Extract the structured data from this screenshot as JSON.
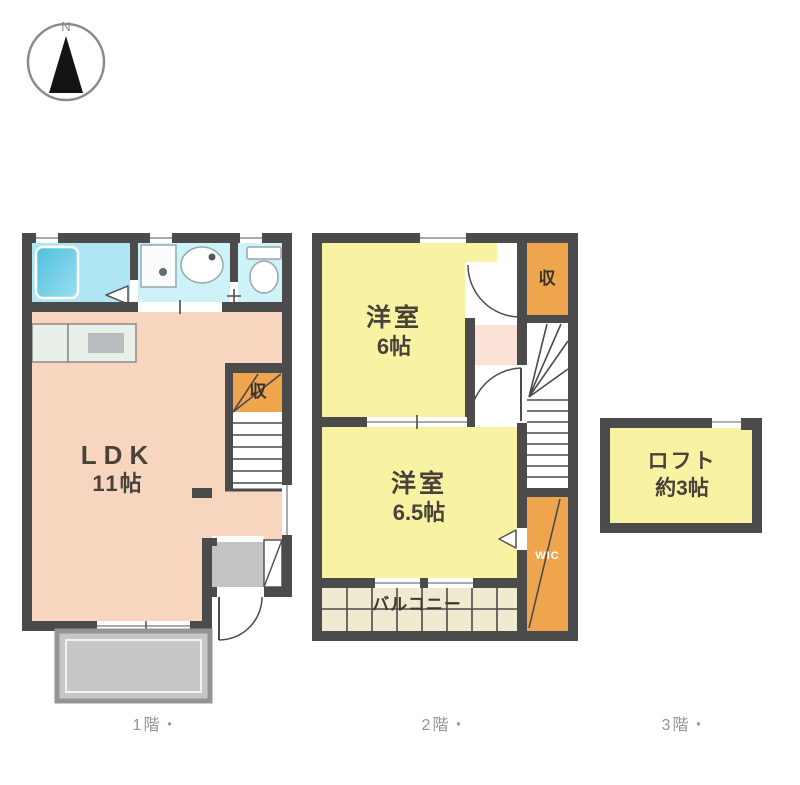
{
  "compass": {
    "north": "N"
  },
  "floor1": {
    "caption": "1階・",
    "ldk_name": "LDK",
    "ldk_size": "11帖",
    "closet": "収"
  },
  "floor2": {
    "caption": "2階・",
    "bedroom_a_name": "洋室",
    "bedroom_a_size": "6帖",
    "bedroom_b_name": "洋室",
    "bedroom_b_size": "6.5帖",
    "closet": "収",
    "wic": "WIC",
    "balcony": "バルコニー"
  },
  "floor3": {
    "caption": "3階・",
    "loft_name": "ロフト",
    "loft_size": "約3帖"
  },
  "colors": {
    "wall": "#4b4b4b",
    "room_yellow": "#f7f3a3",
    "closet_orange": "#efa54e",
    "ldk_salmon": "#f8d5bf",
    "bathroom_cyan": "#aee7f3",
    "washroom_cyan": "#cdf2f8",
    "balcony_cream": "#efead0",
    "terrace_gray": "#c6c6c6",
    "hall_pink": "#fae2d6"
  }
}
